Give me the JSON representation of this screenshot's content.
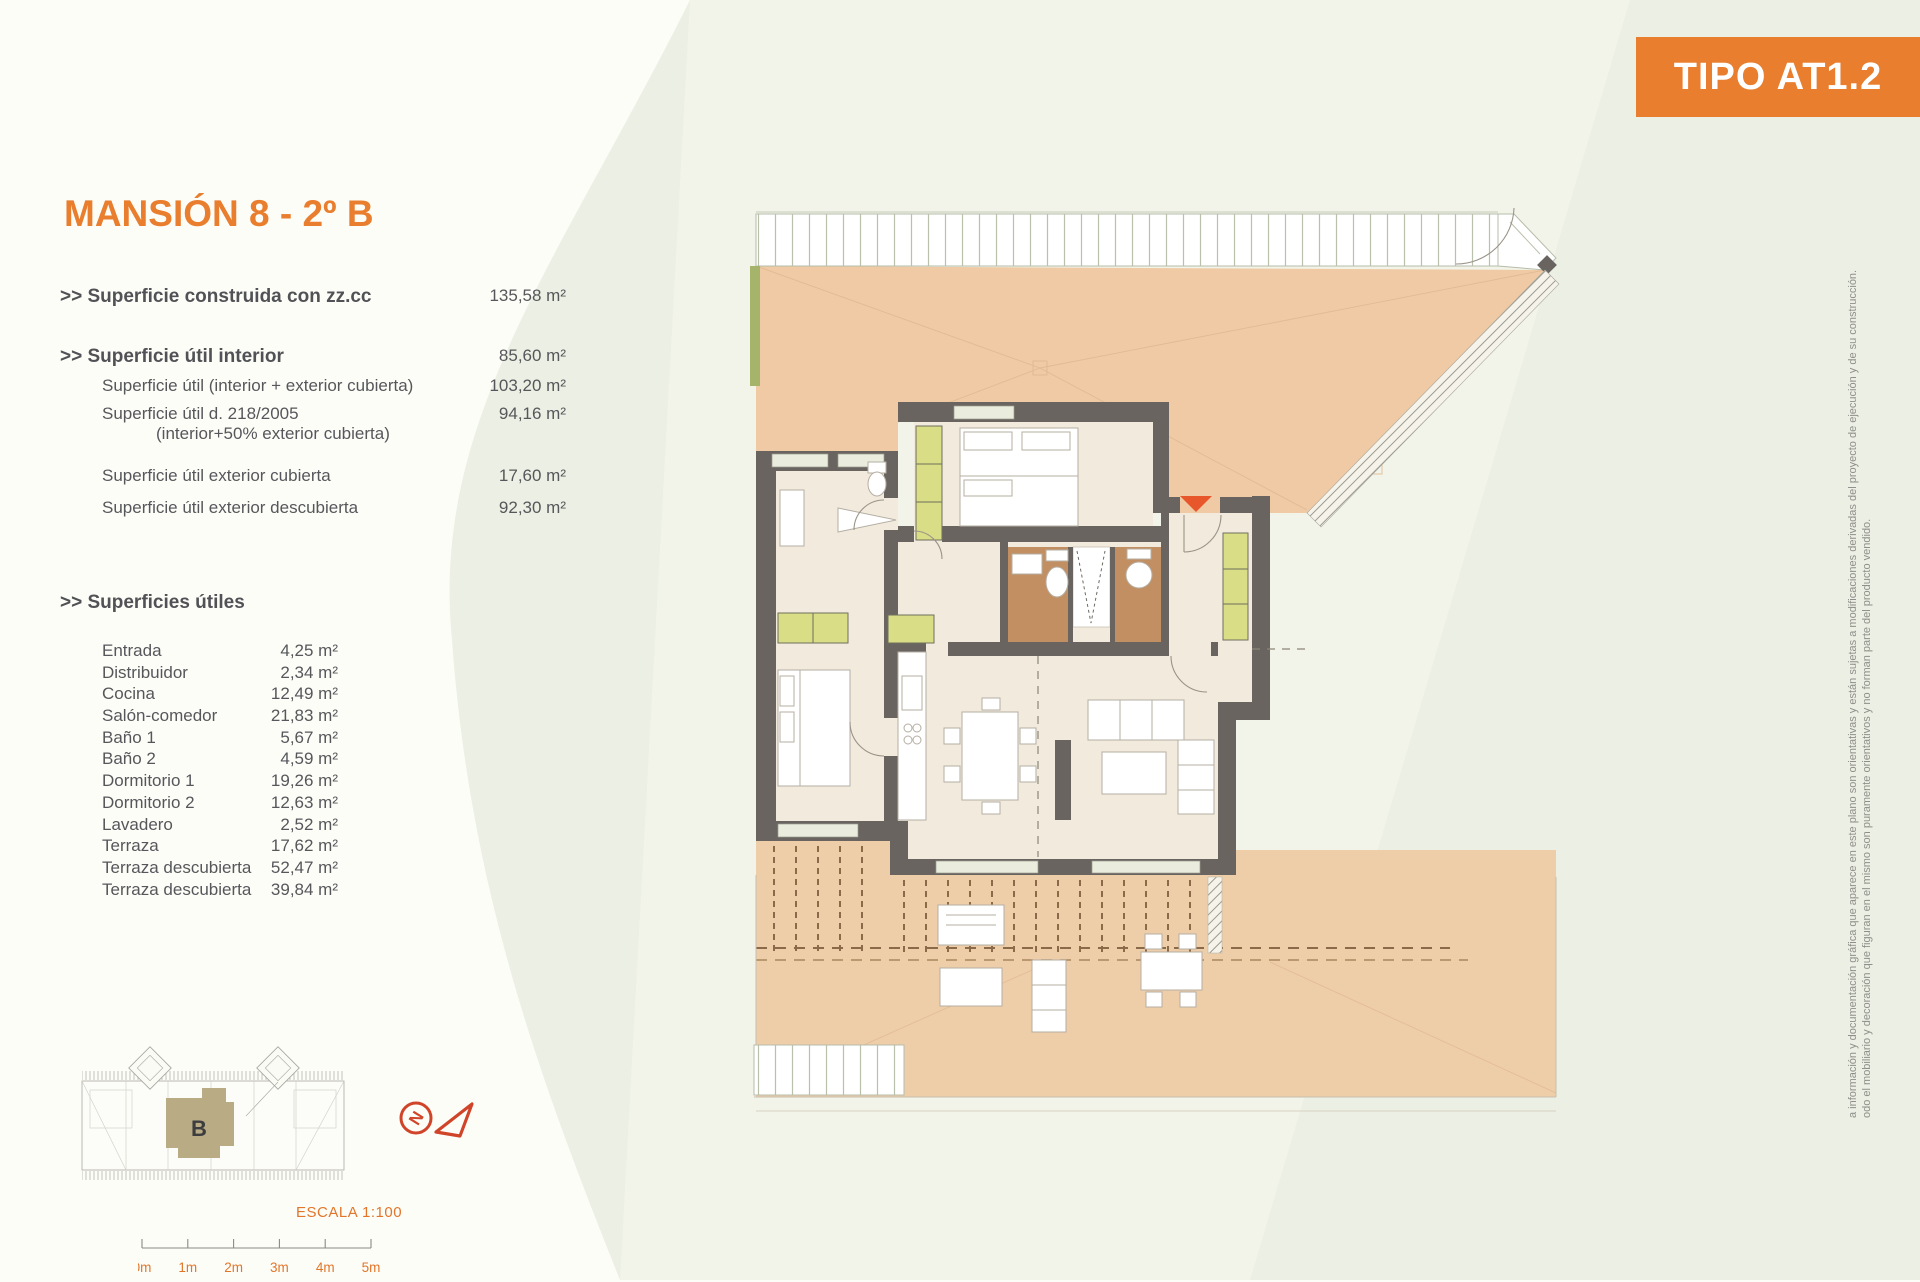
{
  "badge": {
    "label": "TIPO AT1.2"
  },
  "header": {
    "title": "MANSIÓN 8 - 2º B"
  },
  "surface_summary": {
    "rows": [
      {
        "label": ">> Superficie construida con zz.cc",
        "value": "135,58 m²"
      },
      {
        "label": ">> Superficie útil interior",
        "value": "85,60 m²"
      },
      {
        "label": "Superficie útil (interior + exterior cubierta)",
        "value": "103,20 m²"
      },
      {
        "label": "Superficie útil  d. 218/2005",
        "label2": "(interior+50% exterior cubierta)",
        "value": "94,16 m²"
      },
      {
        "label": "Superficie útil exterior cubierta",
        "value": "17,60 m²"
      },
      {
        "label": "Superficie útil exterior descubierta",
        "value": "92,30 m²"
      }
    ]
  },
  "useful_surfaces": {
    "heading": ">> Superficies útiles",
    "rooms": [
      {
        "label": "Entrada",
        "value": "4,25 m²"
      },
      {
        "label": "Distribuidor",
        "value": "2,34 m²"
      },
      {
        "label": "Cocina",
        "value": "12,49 m²"
      },
      {
        "label": "Salón-comedor",
        "value": "21,83 m²"
      },
      {
        "label": "Baño 1",
        "value": "5,67 m²"
      },
      {
        "label": "Baño 2",
        "value": "4,59 m²"
      },
      {
        "label": "Dormitorio 1",
        "value": "19,26 m²"
      },
      {
        "label": "Dormitorio 2",
        "value": "12,63 m²"
      },
      {
        "label": "Lavadero",
        "value": "2,52 m²"
      },
      {
        "label": "Terraza",
        "value": "17,62 m²"
      },
      {
        "label": "Terraza descubierta",
        "value": "52,47 m²"
      },
      {
        "label": "Terraza descubierta",
        "value": "39,84 m²"
      }
    ]
  },
  "key_plan": {
    "unit_label": "B"
  },
  "compass": {
    "label": "N"
  },
  "scale": {
    "label": "ESCALA 1:100",
    "ticks": [
      "0m",
      "1m",
      "2m",
      "3m",
      "4m",
      "5m"
    ]
  },
  "disclaimer": {
    "line1": "a información y documentación gráfica que aparece en este plano son orientativas y están sujetas a modificaciones derivadas del proyecto de ejecución y de su construcción.",
    "line2": "odo el mobiliario y decoración que figuran en el mismo son puramente orientativos y no forman parte del producto vendido."
  },
  "colors": {
    "accent_orange": "#E87E2E",
    "compass_red": "#D0452A",
    "wall": "#6A6460",
    "terrace": "#EFCAA4",
    "interior": "#F1EADD",
    "wardrobe": "#D9DD86",
    "bathroom": "#C28F63"
  }
}
